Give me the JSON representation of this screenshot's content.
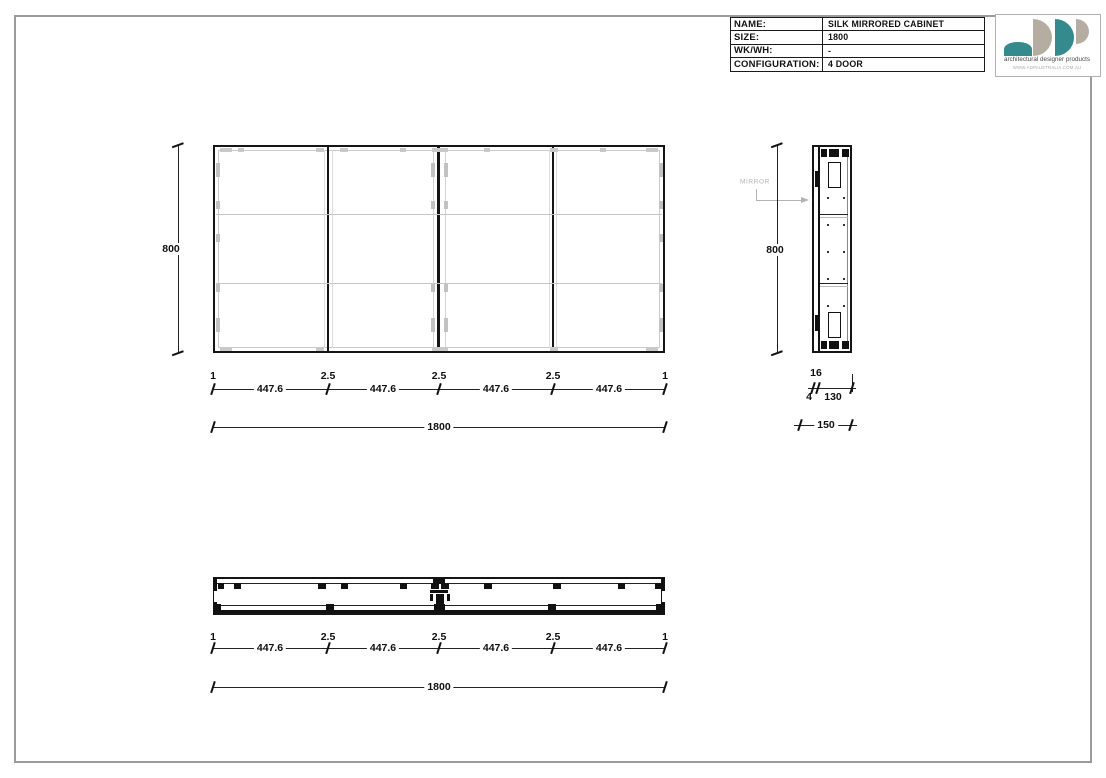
{
  "drawing": {
    "title_block": {
      "rows": [
        {
          "label": "NAME:",
          "value": "SILK MIRRORED CABINET"
        },
        {
          "label": "SIZE:",
          "value": "1800"
        },
        {
          "label": "WK/WH:",
          "value": "-"
        },
        {
          "label": "CONFIGURATION:",
          "value": "4 DOOR"
        }
      ]
    },
    "logo": {
      "tagline": "architectural designer products",
      "website": "WWW.ADPAUSTRALIA.COM.AU",
      "colors": {
        "teal": "#348a8c",
        "taupe": "#b6ada2"
      }
    },
    "front_view": {
      "height": "800",
      "overall_width": "1800",
      "boundaries": [
        "1",
        "2.5",
        "2.5",
        "2.5",
        "1"
      ],
      "segments": [
        "447.6",
        "447.6",
        "447.6",
        "447.6"
      ]
    },
    "side_view": {
      "height": "800",
      "mirror_label": "MIRROR",
      "mirror_thickness": "16",
      "gap": "4",
      "carcass_depth": "130",
      "overall_depth": "150"
    },
    "plan_view": {
      "overall_width": "1800",
      "boundaries": [
        "1",
        "2.5",
        "2.5",
        "2.5",
        "1"
      ],
      "segments": [
        "447.6",
        "447.6",
        "447.6",
        "447.6"
      ]
    }
  }
}
